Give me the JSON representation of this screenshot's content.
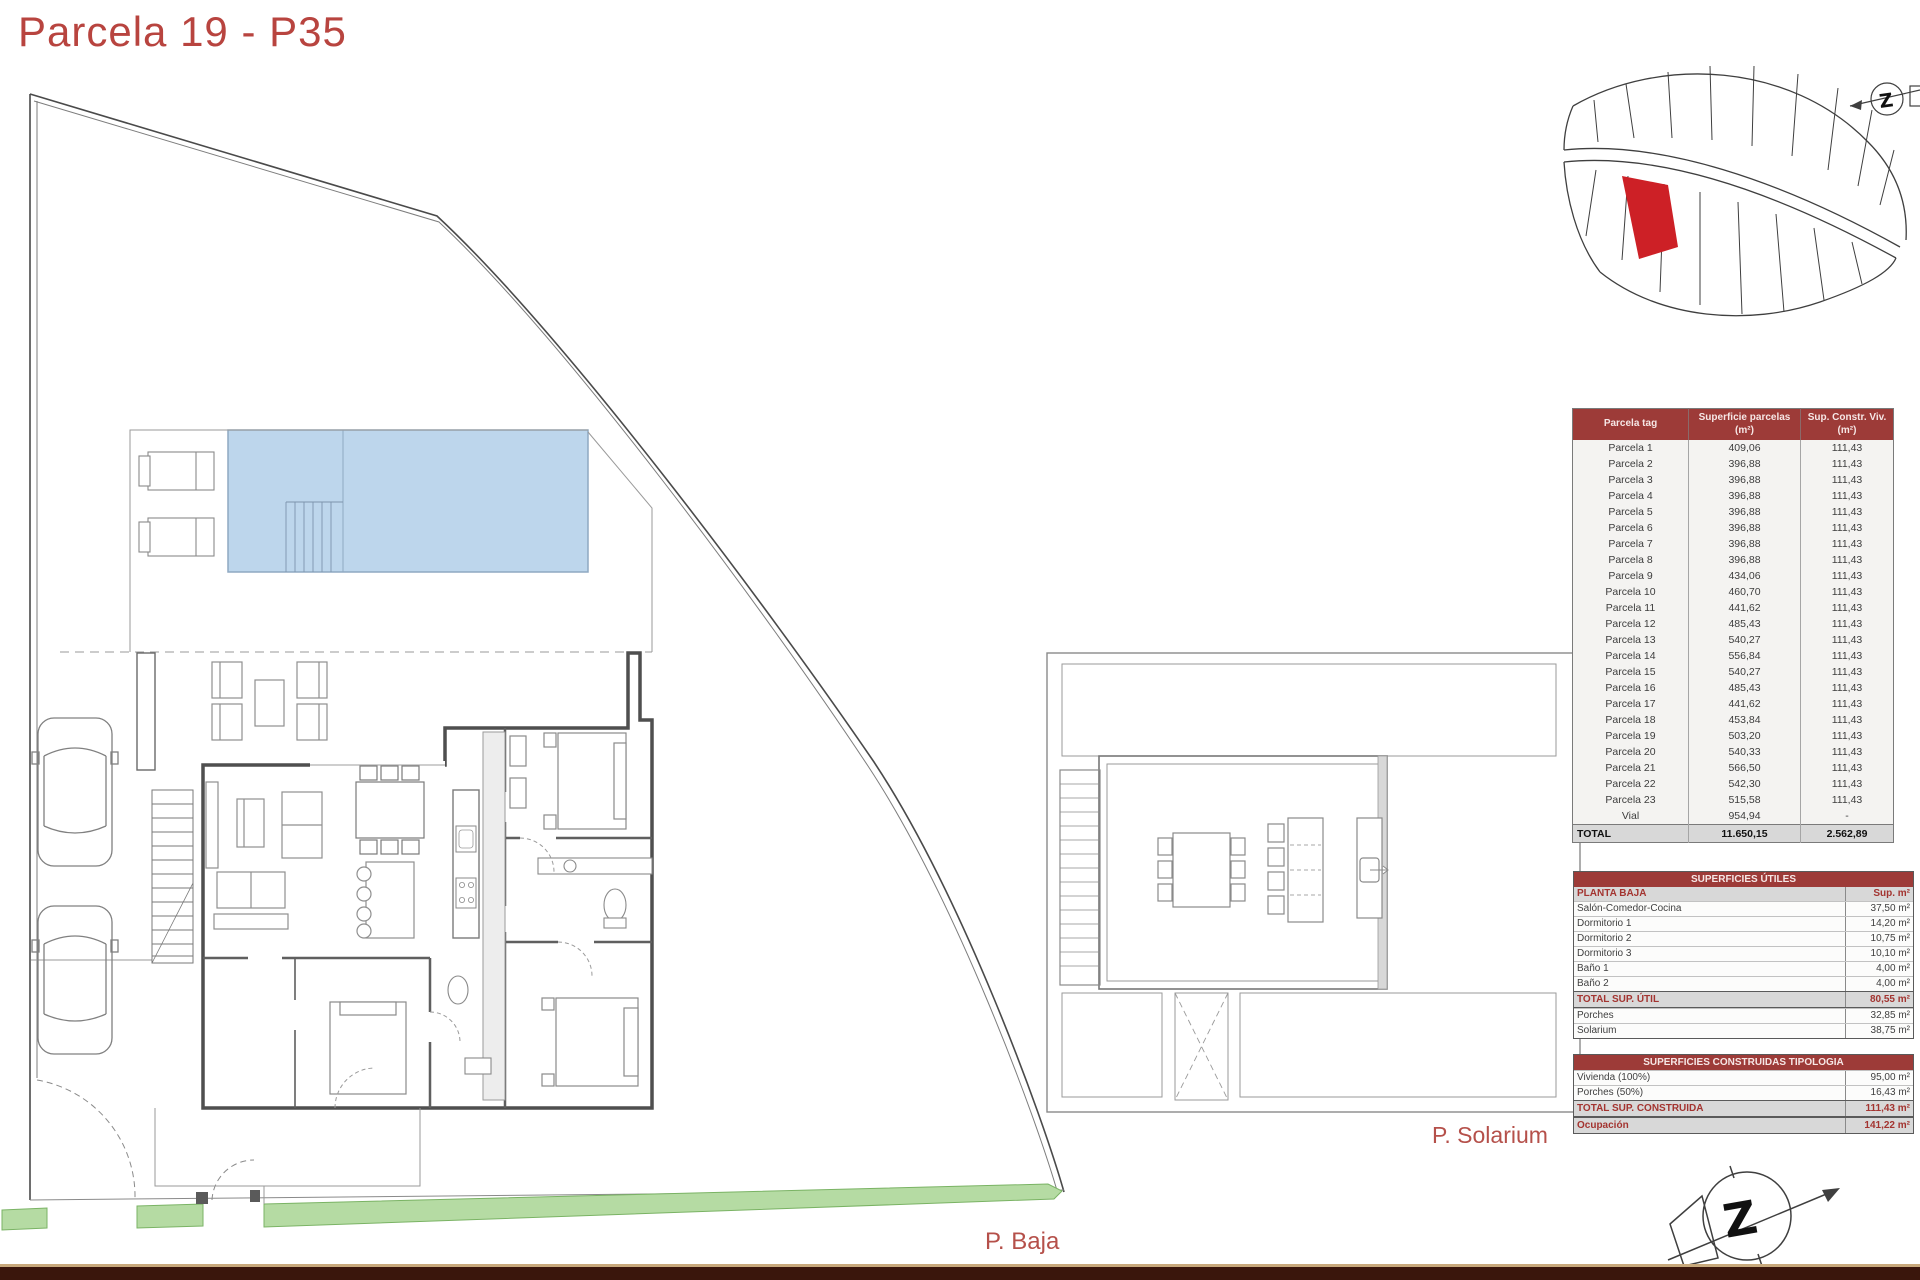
{
  "title": "Parcela 19 - P35",
  "labels": {
    "planta_baja": "P. Baja",
    "solarium": "P. Solarium"
  },
  "parcel_table": {
    "headers": [
      [
        "Parcela tag",
        ""
      ],
      [
        "Superficie parcelas",
        "(m²)"
      ],
      [
        "Sup. Constr. Viv.",
        "(m²)"
      ]
    ],
    "rows": [
      [
        "Parcela 1",
        "409,06",
        "111,43"
      ],
      [
        "Parcela 2",
        "396,88",
        "111,43"
      ],
      [
        "Parcela 3",
        "396,88",
        "111,43"
      ],
      [
        "Parcela 4",
        "396,88",
        "111,43"
      ],
      [
        "Parcela 5",
        "396,88",
        "111,43"
      ],
      [
        "Parcela 6",
        "396,88",
        "111,43"
      ],
      [
        "Parcela 7",
        "396,88",
        "111,43"
      ],
      [
        "Parcela 8",
        "396,88",
        "111,43"
      ],
      [
        "Parcela 9",
        "434,06",
        "111,43"
      ],
      [
        "Parcela 10",
        "460,70",
        "111,43"
      ],
      [
        "Parcela 11",
        "441,62",
        "111,43"
      ],
      [
        "Parcela 12",
        "485,43",
        "111,43"
      ],
      [
        "Parcela 13",
        "540,27",
        "111,43"
      ],
      [
        "Parcela 14",
        "556,84",
        "111,43"
      ],
      [
        "Parcela 15",
        "540,27",
        "111,43"
      ],
      [
        "Parcela 16",
        "485,43",
        "111,43"
      ],
      [
        "Parcela 17",
        "441,62",
        "111,43"
      ],
      [
        "Parcela 18",
        "453,84",
        "111,43"
      ],
      [
        "Parcela 19",
        "503,20",
        "111,43"
      ],
      [
        "Parcela 20",
        "540,33",
        "111,43"
      ],
      [
        "Parcela 21",
        "566,50",
        "111,43"
      ],
      [
        "Parcela 22",
        "542,30",
        "111,43"
      ],
      [
        "Parcela 23",
        "515,58",
        "111,43"
      ],
      [
        "Vial",
        "954,94",
        "-"
      ]
    ],
    "total": [
      "TOTAL",
      "11.650,15",
      "2.562,89"
    ]
  },
  "useful_areas_table": {
    "title": "SUPERFICIES ÚTILES",
    "section": "PLANTA BAJA",
    "value_header": "Sup. m²",
    "rows": [
      [
        "Salón-Comedor-Cocina",
        "37,50 m²"
      ],
      [
        "Dormitorio 1",
        "14,20 m²"
      ],
      [
        "Dormitorio 2",
        "10,75 m²"
      ],
      [
        "Dormitorio 3",
        "10,10 m²"
      ],
      [
        "Baño 1",
        "4,00 m²"
      ],
      [
        "Baño 2",
        "4,00 m²"
      ]
    ],
    "total": [
      "TOTAL SUP. ÚTIL",
      "80,55 m²"
    ],
    "extra_rows": [
      [
        "Porches",
        "32,85 m²"
      ],
      [
        "Solarium",
        "38,75 m²"
      ]
    ]
  },
  "built_areas_table": {
    "title": "SUPERFICIES CONSTRUIDAS TIPOLOGIA",
    "rows": [
      [
        "Vivienda (100%)",
        "95,00 m²"
      ],
      [
        "Porches (50%)",
        "16,43 m²"
      ]
    ],
    "total": [
      "TOTAL SUP. CONSTRUIDA",
      "111,43 m²"
    ],
    "occupation": [
      "Ocupación",
      "141,22 m²"
    ]
  },
  "colors": {
    "accent_red": "#b8443f",
    "table_header_maroon": "#9d3b38",
    "pool_blue": "#bdd6ec",
    "green_strip": "#b5dba3",
    "highlighted_parcel_red": "#cd2026",
    "footer_bar": "#3a160c",
    "footer_line": "#c8a97c"
  }
}
